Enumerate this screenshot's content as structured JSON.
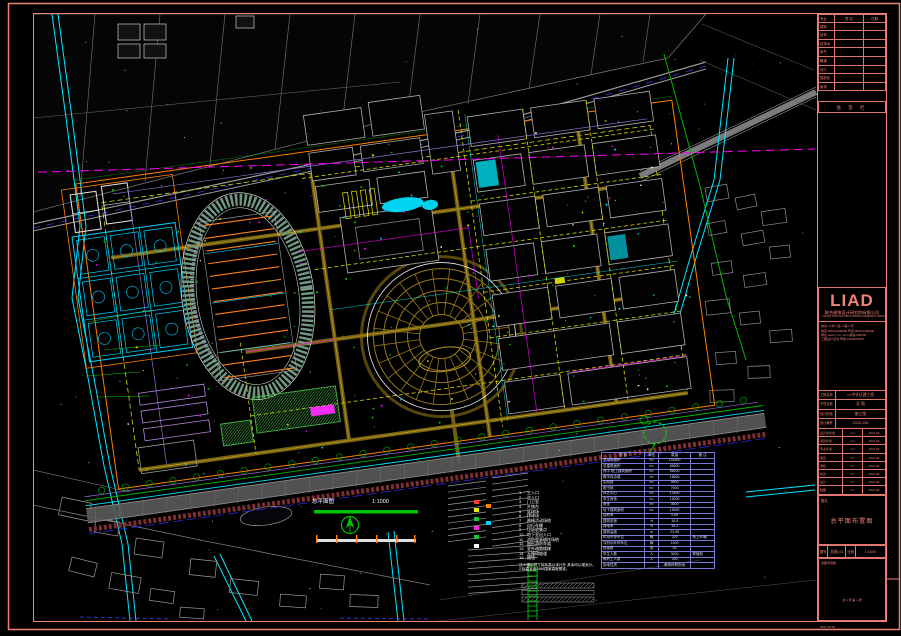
{
  "colors": {
    "background": "#000000",
    "frame": "#f08276",
    "cyan": "#00e8ff",
    "green": "#00c000",
    "magenta": "#ff00ff",
    "yellow": "#e8e800",
    "olive": "#96781a",
    "orange": "#ff7f1e",
    "track_green": "#6f9681",
    "table_blue": "#7878d8",
    "road_gray": "#9a9a9a",
    "water_fill": "#00d2f0",
    "boundary_orange": "#ff8000"
  },
  "title_block": {
    "revision": {
      "headers": [
        "专业",
        "签 名",
        "日期"
      ],
      "rows": [
        {
          "c": "建筑"
        },
        {
          "c": "结构"
        },
        {
          "c": "给排水"
        },
        {
          "c": "电气"
        },
        {
          "c": "暖通"
        },
        {
          "c": "动力"
        },
        {
          "c": "智能化"
        },
        {
          "c": "景观"
        }
      ],
      "footer": "会 签 栏"
    },
    "logo": "LIAD",
    "company_cn": "联合建筑设计研究院有限公司",
    "company_en": "UNITED ARCHITECTURAL DESIGN & RESEARCH INSTITUTE CO.,LTD.",
    "address_lines": [
      "地址:××市××区××路××号",
      "电话:0000-0000000  传真:0000-0000000",
      "网址:www.××××.com  邮编:000000",
      "工程设计证书:甲级 A100000000"
    ],
    "fields": [
      {
        "label": "工程名称",
        "value": "××中学迁建工程"
      },
      {
        "label": "子项名称",
        "value": "总 图"
      },
      {
        "label": "设计阶段",
        "value": "施工图"
      },
      {
        "label": "设计编号",
        "value": "2020-156"
      }
    ],
    "signatures": [
      {
        "role": "设计总负责",
        "name": "×××",
        "date": "2021.02"
      },
      {
        "role": "项目负责",
        "name": "×××",
        "date": "2021.02"
      },
      {
        "role": "专业负责",
        "name": "×××",
        "date": "2021.02"
      },
      {
        "role": "审定",
        "name": "×××",
        "date": "2021.02"
      },
      {
        "role": "审核",
        "name": "×××",
        "date": "2021.02"
      },
      {
        "role": "校对",
        "name": "×××",
        "date": "2021.02"
      },
      {
        "role": "设计",
        "name": "×××",
        "date": "2021.02"
      },
      {
        "role": "制图",
        "name": "×××",
        "date": "2021.02"
      }
    ],
    "drawing_name_label": "图名",
    "drawing_name": "总平面布置图",
    "drawing_no_label": "图号",
    "drawing_no": "总施-01",
    "scale_label": "比例",
    "scale": "1:1000",
    "stamp_box_label": "出图专用章",
    "sheet_note": "共 1 张  第 1 张",
    "footer_note": "2021.02.08"
  },
  "map": {
    "scale_bar": {
      "title": "总平面图",
      "ratio": "1:1000"
    },
    "labels": [
      {
        "t": "朱家河",
        "x": 314,
        "y": 55,
        "c": "#ffffff",
        "s": 6
      },
      {
        "t": "规划城市道路(远期实施)",
        "x": 714,
        "y": 100,
        "c": "#ffffff",
        "s": 4,
        "rot": -16
      },
      {
        "t": "现状村庄",
        "x": 50,
        "y": 318
      },
      {
        "t": "规划河道",
        "x": 72,
        "y": 347
      },
      {
        "t": "防护绿带",
        "x": 50,
        "y": 373
      },
      {
        "t": "市政道路",
        "x": 62,
        "y": 394
      },
      {
        "t": "现状水塘",
        "x": 94,
        "y": 450
      },
      {
        "t": "网球场",
        "x": 96,
        "y": 240
      },
      {
        "t": "篮球场",
        "x": 118,
        "y": 296
      },
      {
        "t": "田径运动场",
        "x": 226,
        "y": 304,
        "s": 5
      },
      {
        "t": "看台",
        "x": 204,
        "y": 252,
        "s": 3.5
      },
      {
        "t": "体艺中心",
        "x": 426,
        "y": 332,
        "s": 5
      },
      {
        "t": "教学楼",
        "x": 318,
        "y": 203
      },
      {
        "t": "实验楼",
        "x": 374,
        "y": 176
      },
      {
        "t": "综合楼",
        "x": 430,
        "y": 151
      },
      {
        "t": "合班教室",
        "x": 478,
        "y": 134,
        "s": 3.5
      },
      {
        "t": "行政楼",
        "x": 498,
        "y": 196
      },
      {
        "t": "图书馆",
        "x": 562,
        "y": 127
      },
      {
        "t": "报告厅",
        "x": 556,
        "y": 186
      },
      {
        "t": "宿舍楼",
        "x": 614,
        "y": 114
      },
      {
        "t": "宿舍楼",
        "x": 650,
        "y": 140
      },
      {
        "t": "食堂",
        "x": 610,
        "y": 172
      },
      {
        "t": "升旗广场",
        "x": 362,
        "y": 260,
        "s": 3.5
      },
      {
        "t": "连廊",
        "x": 470,
        "y": 248,
        "s": 3.5
      },
      {
        "t": "主入口",
        "x": 514,
        "y": 318
      },
      {
        "t": "次入口",
        "x": 606,
        "y": 294
      },
      {
        "t": "停车场",
        "x": 648,
        "y": 224
      },
      {
        "t": "自行车棚",
        "x": 554,
        "y": 352,
        "s": 3.5
      },
      {
        "t": "配电房",
        "x": 636,
        "y": 334,
        "s": 3.5
      },
      {
        "t": "门卫",
        "x": 298,
        "y": 430,
        "s": 3.5
      },
      {
        "t": "地下车库出入口",
        "x": 400,
        "y": 412,
        "s": 3.5
      },
      {
        "t": "食堂后勤区",
        "x": 304,
        "y": 360,
        "s": 3.5
      },
      {
        "t": "围墙",
        "x": 196,
        "y": 428,
        "s": 3.5
      },
      {
        "t": "规划支路",
        "x": 138,
        "y": 466
      },
      {
        "t": "现状民居",
        "x": 724,
        "y": 250
      },
      {
        "t": "现状农田",
        "x": 754,
        "y": 308
      },
      {
        "t": "道路结构做法",
        "x": 520,
        "y": 598,
        "s": 3.5
      },
      {
        "t": "绿化种植详见景观设计",
        "x": 660,
        "y": 378,
        "c": "#8fe08f",
        "s": 3.5
      }
    ],
    "legend": {
      "items": [
        {
          "no": "1",
          "text": "主入口"
        },
        {
          "no": "2",
          "text": "次入口"
        },
        {
          "no": "3",
          "text": "门卫室"
        },
        {
          "no": "4",
          "text": "升旗台"
        },
        {
          "no": "5",
          "text": "篮球场"
        },
        {
          "no": "6",
          "text": "排球场"
        },
        {
          "no": "7",
          "text": "器械活动场地"
        },
        {
          "no": "8",
          "text": "自行车棚"
        },
        {
          "no": "9",
          "text": "垃圾收集点"
        },
        {
          "no": "10",
          "text": "地下室出入口"
        },
        {
          "no": "11",
          "text": "消防登高操作场地"
        },
        {
          "no": "12",
          "text": "隐形消防车道"
        },
        {
          "no": "13",
          "text": "室外疏散楼梯"
        },
        {
          "no": "14",
          "text": "无障碍坡道"
        },
        {
          "no": "15",
          "text": "围墙"
        }
      ],
      "swatches": [
        {
          "x": 474,
          "y": 500,
          "swatch": "#ff3b30"
        },
        {
          "x": 474,
          "y": 508,
          "swatch": "#e8e800"
        },
        {
          "x": 474,
          "y": 517,
          "swatch": "#22bb44"
        },
        {
          "x": 474,
          "y": 526,
          "swatch": "#ff2dce"
        },
        {
          "x": 474,
          "y": 535,
          "swatch": "#22bb44"
        },
        {
          "x": 474,
          "y": 544,
          "swatch": "#ffffff"
        },
        {
          "x": 486,
          "y": 504,
          "swatch": "#ff8000"
        },
        {
          "x": 486,
          "y": 521,
          "swatch": "#00cfff"
        }
      ]
    },
    "notes": [
      "注:1.图中尺寸除标高以米计外,其余均以毫米计。",
      "   2.标高采用1985国家高程基准。"
    ],
    "table": {
      "headers": [
        "项  目",
        "单位",
        "数量",
        "备 注"
      ],
      "rows": [
        [
          "总用地面积",
          "m²",
          "102600",
          ""
        ],
        [
          "总建筑面积",
          "m²",
          "86500",
          ""
        ],
        [
          "其中 地上建筑面积",
          "m²",
          "68200",
          ""
        ],
        [
          "教学综合楼",
          "m²",
          "18600",
          ""
        ],
        [
          "实验楼",
          "m²",
          "9800",
          ""
        ],
        [
          "图书馆",
          "m²",
          "7600",
          ""
        ],
        [
          "体艺中心",
          "m²",
          "12400",
          ""
        ],
        [
          "学生宿舍",
          "m²",
          "15200",
          ""
        ],
        [
          "食堂",
          "m²",
          "4600",
          ""
        ],
        [
          "地下建筑面积",
          "m²",
          "18300",
          ""
        ],
        [
          "容积率",
          "",
          "0.66",
          ""
        ],
        [
          "建筑密度",
          "%",
          "18.5",
          ""
        ],
        [
          "绿地率",
          "%",
          "35.2",
          ""
        ],
        [
          "建筑高度",
          "m",
          "23.95",
          ""
        ],
        [
          "机动车停车位",
          "辆",
          "320",
          "地上60辆"
        ],
        [
          "非机动车停车位",
          "辆",
          "1500",
          ""
        ],
        [
          "班级数",
          "班",
          "60",
          ""
        ],
        [
          "学生人数",
          "人",
          "3000",
          "寄宿制"
        ],
        [
          "教职工人数",
          "人",
          "240",
          ""
        ],
        [
          "用地性质",
          "",
          "教育科研用地",
          ""
        ]
      ]
    }
  }
}
